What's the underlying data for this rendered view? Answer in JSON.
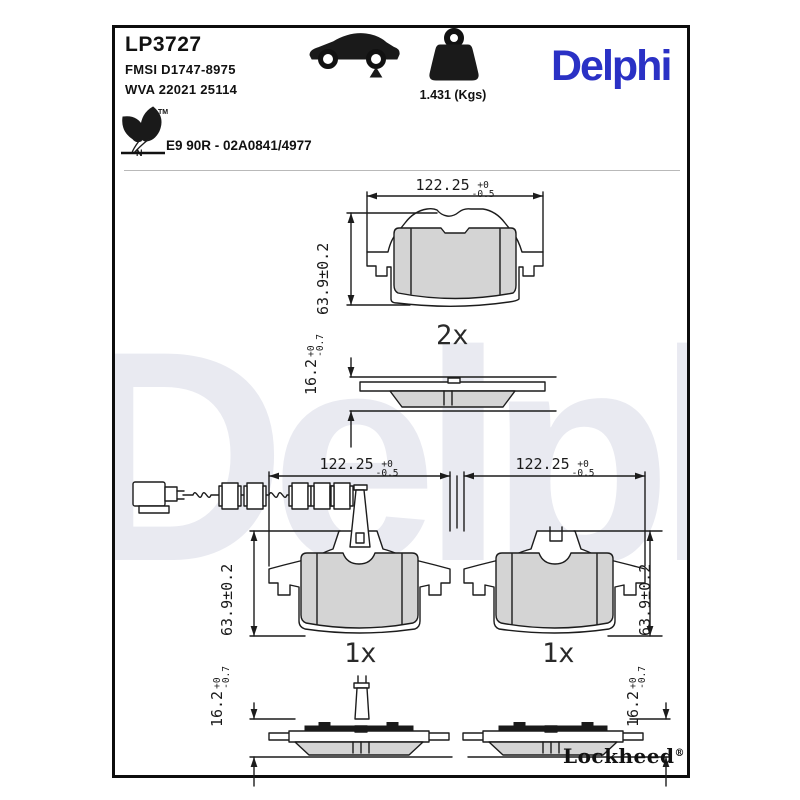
{
  "header": {
    "part_number": "LP3727",
    "fmsi": "FMSI D1747-8975",
    "wva": "WVA 22021 25114",
    "weight_label": "1.431 (Kgs)",
    "brand_logo": "Delphi",
    "homologation": "E9 90R - 02A0841/4977",
    "eco_letter": "N",
    "trademark": "TM"
  },
  "drawing": {
    "top_view": {
      "qty": "2x",
      "width": {
        "value": "122.25",
        "plus": "+0",
        "minus": "-0.5"
      },
      "height": "63.9±0.2",
      "thickness": {
        "value": "16.2",
        "plus": "+0",
        "minus": "-0.7"
      }
    },
    "bottom_left_view": {
      "qty": "1x",
      "width": {
        "value": "122.25",
        "plus": "+0",
        "minus": "-0.5"
      },
      "height": "63.9±0.2",
      "thickness": {
        "value": "16.2",
        "plus": "+0",
        "minus": "-0.7"
      }
    },
    "bottom_right_view": {
      "qty": "1x",
      "width": {
        "value": "122.25",
        "plus": "+0",
        "minus": "-0.5"
      },
      "height": "63.9±0.2",
      "thickness": {
        "value": "16.2",
        "plus": "+0",
        "minus": "-0.7"
      }
    }
  },
  "footer": {
    "manufacturer": "Lockheed",
    "registered": "®"
  },
  "watermark": "Delphi",
  "colors": {
    "brand_blue": "#2a31c5",
    "watermark": "#e9eaf1",
    "friction_gray": "#d4d4d4",
    "line_col": "#1c1c1c"
  }
}
